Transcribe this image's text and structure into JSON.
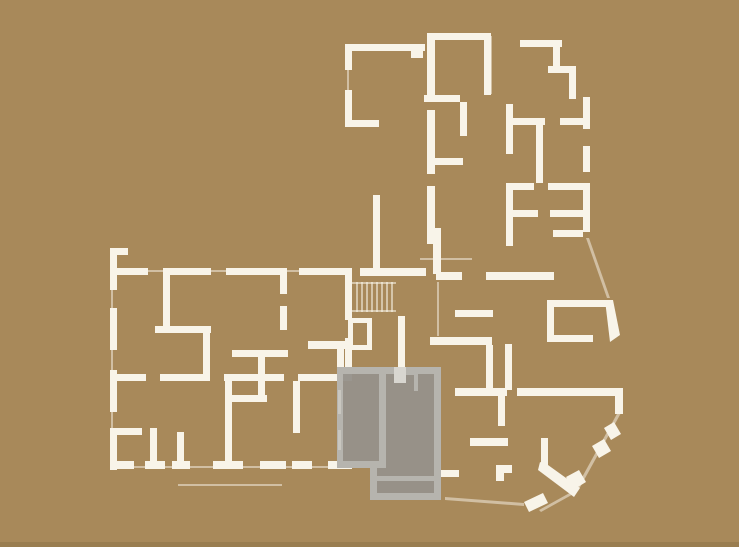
{
  "page": {
    "kind": "architectural-floor-plan-view",
    "colors": {
      "background": "#a8895a",
      "wall": "#f8f4e9",
      "faint": "rgba(250,246,235,0.5)",
      "footer": "#997d50"
    }
  },
  "floorplan": {
    "selected_unit": {
      "state": "selected",
      "fill": "rgba(150,146,138,0.96)",
      "wall": "#b6b4ae",
      "accent": "#d8d6d0",
      "window_mark": "#c9c7c0"
    },
    "stairs": {
      "line": "rgba(250,246,235,0.55)"
    }
  }
}
